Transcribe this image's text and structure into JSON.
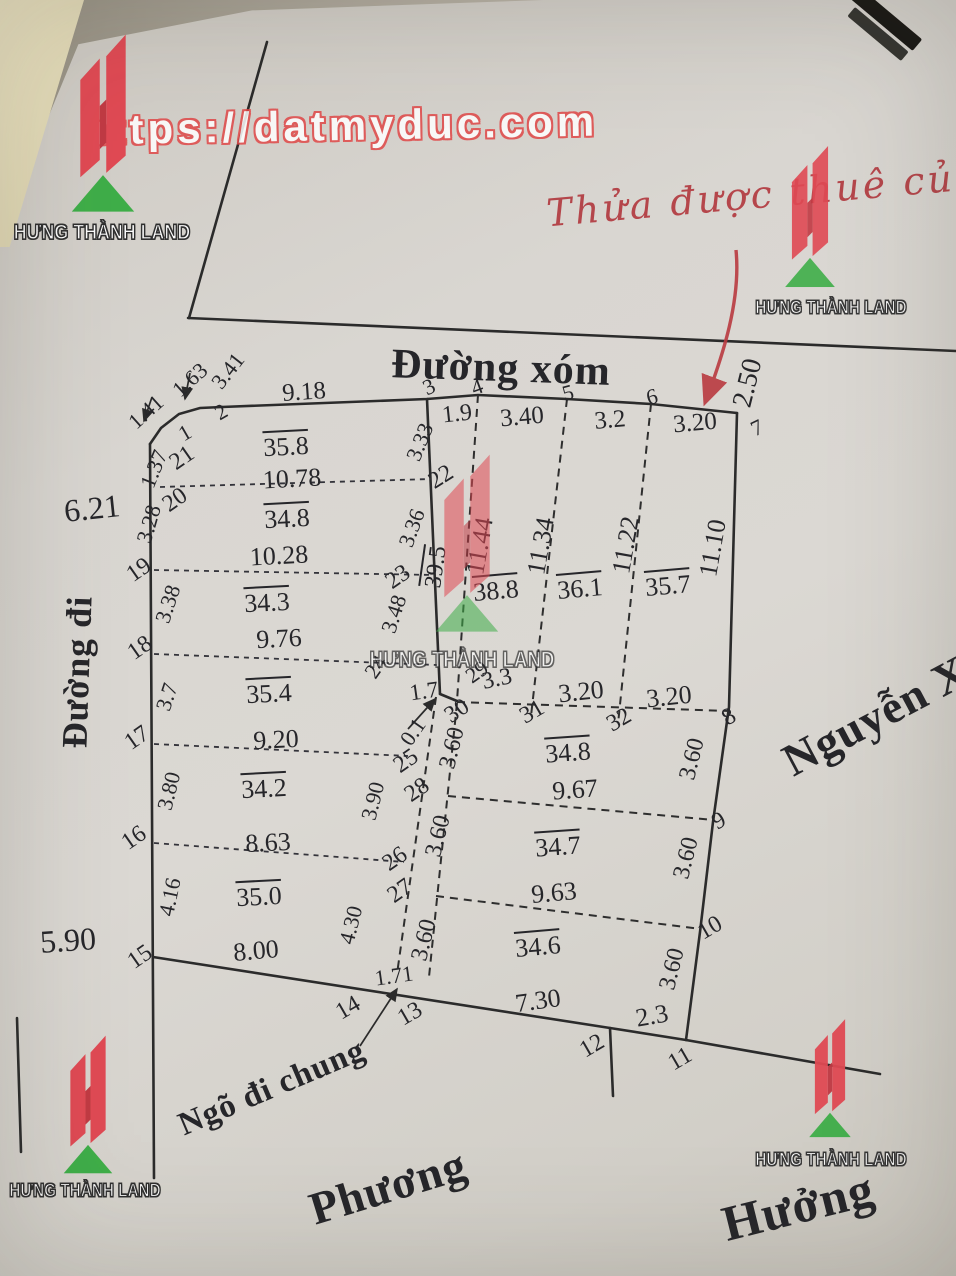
{
  "brand": "HƯNG THÀNH LAND",
  "watermark_url": "https://datmyduc.com",
  "handwriting": "Thửa được thuê của t",
  "colors": {
    "line": "#2b2b2b",
    "red_mark": "#b93a40",
    "logo_red": "#e04a54",
    "logo_green": "#3fae49",
    "paper": "#d9d6d1"
  },
  "roads": {
    "top": "Đường xóm",
    "left": "Đường đi",
    "alley": "Ngõ đi chung",
    "neighbor_bottom_left": "Phương",
    "neighbor_bottom_right": "Hưởng",
    "neighbor_right": "Nguyễn X"
  },
  "labels": [
    {
      "t": "https://datmyduc.com",
      "x": 340,
      "y": 126,
      "r": -1,
      "s": 42,
      "c": "url",
      "n": "watermark-url"
    },
    {
      "t": "Thửa được thuê của t",
      "x": 780,
      "y": 193,
      "r": -5,
      "s": 38,
      "c": "hand",
      "n": "handwritten-note"
    },
    {
      "t": "Đường xóm",
      "x": 501,
      "y": 368,
      "r": 2,
      "s": 42,
      "c": "road",
      "n": "top-road-label"
    },
    {
      "t": "Đường đi",
      "x": 77,
      "y": 672,
      "r": -88,
      "s": 36,
      "c": "road",
      "n": "left-road-label"
    },
    {
      "t": "Ngõ đi chung",
      "x": 272,
      "y": 1088,
      "r": -23,
      "s": 33,
      "c": "road2",
      "n": "alley-label"
    },
    {
      "t": "Phương",
      "x": 388,
      "y": 1187,
      "r": -17,
      "s": 46,
      "c": "road2",
      "n": "neighbor-phuong-label"
    },
    {
      "t": "Hưởng",
      "x": 798,
      "y": 1206,
      "r": -14,
      "s": 50,
      "c": "road2",
      "n": "neighbor-huong-label"
    },
    {
      "t": "Nguyễn X",
      "x": 876,
      "y": 716,
      "r": -28,
      "s": 46,
      "c": "road2",
      "n": "neighbor-nguyen-label"
    },
    {
      "t": "6.21",
      "x": 92,
      "y": 508,
      "r": -6,
      "s": 32,
      "c": "num",
      "n": "measure"
    },
    {
      "t": "5.90",
      "x": 68,
      "y": 940,
      "r": -4,
      "s": 32,
      "c": "num",
      "n": "measure"
    },
    {
      "t": "2.50",
      "x": 748,
      "y": 383,
      "r": -76,
      "s": 28,
      "c": "num",
      "n": "measure"
    },
    {
      "t": "1.63",
      "x": 190,
      "y": 380,
      "r": -42,
      "s": 22,
      "c": "num",
      "n": "measure"
    },
    {
      "t": "3.41",
      "x": 228,
      "y": 371,
      "r": -52,
      "s": 22,
      "c": "num",
      "n": "measure"
    },
    {
      "t": "9.18",
      "x": 304,
      "y": 392,
      "r": -4,
      "s": 25,
      "c": "num",
      "n": "measure"
    },
    {
      "t": "1.41",
      "x": 146,
      "y": 412,
      "r": -42,
      "s": 22,
      "c": "num",
      "n": "measure"
    },
    {
      "t": "2",
      "x": 221,
      "y": 412,
      "r": -30,
      "s": 22,
      "c": "pt",
      "n": "point-2"
    },
    {
      "t": "1",
      "x": 185,
      "y": 433,
      "r": -30,
      "s": 22,
      "c": "pt",
      "n": "point-1"
    },
    {
      "t": "1.37",
      "x": 154,
      "y": 469,
      "r": -68,
      "s": 22,
      "c": "num",
      "n": "measure"
    },
    {
      "t": "21",
      "x": 182,
      "y": 458,
      "r": -35,
      "s": 24,
      "c": "pt",
      "n": "point-21"
    },
    {
      "t": "20",
      "x": 175,
      "y": 500,
      "r": -35,
      "s": 24,
      "c": "pt",
      "n": "point-20"
    },
    {
      "t": "3.28",
      "x": 149,
      "y": 524,
      "r": -74,
      "s": 22,
      "c": "num",
      "n": "measure"
    },
    {
      "t": "19",
      "x": 139,
      "y": 570,
      "r": -35,
      "s": 24,
      "c": "pt",
      "n": "point-19"
    },
    {
      "t": "3.38",
      "x": 168,
      "y": 604,
      "r": -72,
      "s": 22,
      "c": "num",
      "n": "measure"
    },
    {
      "t": "18",
      "x": 140,
      "y": 648,
      "r": -35,
      "s": 24,
      "c": "pt",
      "n": "point-18"
    },
    {
      "t": "3.7",
      "x": 167,
      "y": 697,
      "r": -72,
      "s": 22,
      "c": "num",
      "n": "measure"
    },
    {
      "t": "17",
      "x": 137,
      "y": 738,
      "r": -35,
      "s": 24,
      "c": "pt",
      "n": "point-17"
    },
    {
      "t": "3.80",
      "x": 169,
      "y": 791,
      "r": -76,
      "s": 22,
      "c": "num",
      "n": "measure"
    },
    {
      "t": "16",
      "x": 134,
      "y": 838,
      "r": -35,
      "s": 24,
      "c": "pt",
      "n": "point-16"
    },
    {
      "t": "4.16",
      "x": 170,
      "y": 897,
      "r": -78,
      "s": 22,
      "c": "num",
      "n": "measure"
    },
    {
      "t": "15",
      "x": 140,
      "y": 957,
      "r": -35,
      "s": 24,
      "c": "pt",
      "n": "point-15"
    },
    {
      "t": "35.8",
      "x": 286,
      "y": 447,
      "r": -3,
      "s": 26,
      "c": "area",
      "n": "parcel-area"
    },
    {
      "t": "10.78",
      "x": 292,
      "y": 479,
      "r": -3,
      "s": 26,
      "c": "num",
      "n": "measure"
    },
    {
      "t": "34.8",
      "x": 287,
      "y": 519,
      "r": -3,
      "s": 26,
      "c": "area",
      "n": "parcel-area"
    },
    {
      "t": "10.28",
      "x": 279,
      "y": 556,
      "r": -3,
      "s": 26,
      "c": "num",
      "n": "measure"
    },
    {
      "t": "34.3",
      "x": 267,
      "y": 603,
      "r": -3,
      "s": 26,
      "c": "area",
      "n": "parcel-area"
    },
    {
      "t": "9.76",
      "x": 279,
      "y": 639,
      "r": -3,
      "s": 26,
      "c": "num",
      "n": "measure"
    },
    {
      "t": "35.4",
      "x": 269,
      "y": 694,
      "r": -3,
      "s": 26,
      "c": "area",
      "n": "parcel-area"
    },
    {
      "t": "9.20",
      "x": 276,
      "y": 740,
      "r": -3,
      "s": 26,
      "c": "num",
      "n": "measure"
    },
    {
      "t": "34.2",
      "x": 264,
      "y": 789,
      "r": -3,
      "s": 26,
      "c": "area",
      "n": "parcel-area"
    },
    {
      "t": "8.63",
      "x": 268,
      "y": 843,
      "r": -3,
      "s": 26,
      "c": "num",
      "n": "measure"
    },
    {
      "t": "35.0",
      "x": 259,
      "y": 897,
      "r": -3,
      "s": 26,
      "c": "area",
      "n": "parcel-area"
    },
    {
      "t": "8.00",
      "x": 256,
      "y": 951,
      "r": -5,
      "s": 26,
      "c": "num",
      "n": "measure"
    },
    {
      "t": "3",
      "x": 429,
      "y": 387,
      "r": -25,
      "s": 22,
      "c": "pt",
      "n": "point-3"
    },
    {
      "t": "3.33",
      "x": 420,
      "y": 442,
      "r": -68,
      "s": 22,
      "c": "num",
      "n": "measure"
    },
    {
      "t": "22",
      "x": 441,
      "y": 477,
      "r": -32,
      "s": 24,
      "c": "pt",
      "n": "point-22"
    },
    {
      "t": "3.36",
      "x": 412,
      "y": 528,
      "r": -70,
      "s": 22,
      "c": "num",
      "n": "measure"
    },
    {
      "t": "23",
      "x": 398,
      "y": 577,
      "r": -35,
      "s": 24,
      "c": "pt",
      "n": "point-23"
    },
    {
      "t": "3.48",
      "x": 394,
      "y": 614,
      "r": -72,
      "s": 22,
      "c": "num",
      "n": "measure"
    },
    {
      "t": "24",
      "x": 376,
      "y": 667,
      "r": -55,
      "s": 22,
      "c": "pt",
      "n": "point-24"
    },
    {
      "t": "1.9",
      "x": 457,
      "y": 414,
      "r": -6,
      "s": 24,
      "c": "num",
      "n": "measure"
    },
    {
      "t": "4",
      "x": 477,
      "y": 387,
      "r": -20,
      "s": 22,
      "c": "pt",
      "n": "point-4"
    },
    {
      "t": "3.40",
      "x": 522,
      "y": 417,
      "r": -5,
      "s": 25,
      "c": "num",
      "n": "measure"
    },
    {
      "t": "5",
      "x": 568,
      "y": 393,
      "r": -15,
      "s": 22,
      "c": "pt",
      "n": "point-5"
    },
    {
      "t": "3.2",
      "x": 610,
      "y": 420,
      "r": -5,
      "s": 25,
      "c": "num",
      "n": "measure"
    },
    {
      "t": "6",
      "x": 652,
      "y": 397,
      "r": -15,
      "s": 22,
      "c": "pt",
      "n": "point-6"
    },
    {
      "t": "3.20",
      "x": 695,
      "y": 423,
      "r": -5,
      "s": 25,
      "c": "num",
      "n": "measure"
    },
    {
      "t": "7",
      "x": 757,
      "y": 428,
      "r": -25,
      "s": 22,
      "c": "pt",
      "n": "point-7"
    },
    {
      "t": "39.5",
      "x": 436,
      "y": 567,
      "r": -82,
      "s": 24,
      "c": "area",
      "n": "parcel-area"
    },
    {
      "t": "11.44",
      "x": 480,
      "y": 546,
      "r": -80,
      "s": 26,
      "c": "num",
      "n": "measure"
    },
    {
      "t": "38.8",
      "x": 496,
      "y": 591,
      "r": -5,
      "s": 26,
      "c": "area",
      "n": "parcel-area"
    },
    {
      "t": "11.34",
      "x": 541,
      "y": 546,
      "r": -80,
      "s": 26,
      "c": "num",
      "n": "measure"
    },
    {
      "t": "36.1",
      "x": 580,
      "y": 589,
      "r": -5,
      "s": 26,
      "c": "area",
      "n": "parcel-area"
    },
    {
      "t": "11.22",
      "x": 626,
      "y": 545,
      "r": -80,
      "s": 26,
      "c": "num",
      "n": "measure"
    },
    {
      "t": "35.7",
      "x": 668,
      "y": 586,
      "r": -5,
      "s": 26,
      "c": "area",
      "n": "parcel-area"
    },
    {
      "t": "11.10",
      "x": 713,
      "y": 548,
      "r": -80,
      "s": 26,
      "c": "num",
      "n": "measure"
    },
    {
      "t": "1.7",
      "x": 424,
      "y": 691,
      "r": -8,
      "s": 23,
      "c": "num",
      "n": "measure"
    },
    {
      "t": "29",
      "x": 477,
      "y": 672,
      "r": -35,
      "s": 22,
      "c": "pt",
      "n": "point-29"
    },
    {
      "t": "3.3",
      "x": 497,
      "y": 679,
      "r": -12,
      "s": 24,
      "c": "num",
      "n": "measure"
    },
    {
      "t": "0.1",
      "x": 413,
      "y": 732,
      "r": -55,
      "s": 22,
      "c": "num",
      "n": "measure"
    },
    {
      "t": "30",
      "x": 457,
      "y": 711,
      "r": -35,
      "s": 24,
      "c": "pt",
      "n": "point-30"
    },
    {
      "t": "31",
      "x": 532,
      "y": 712,
      "r": -30,
      "s": 24,
      "c": "pt",
      "n": "point-31"
    },
    {
      "t": "3.20",
      "x": 581,
      "y": 692,
      "r": -6,
      "s": 26,
      "c": "num",
      "n": "measure"
    },
    {
      "t": "32",
      "x": 619,
      "y": 720,
      "r": -30,
      "s": 24,
      "c": "pt",
      "n": "point-32"
    },
    {
      "t": "3.20",
      "x": 669,
      "y": 697,
      "r": -6,
      "s": 26,
      "c": "num",
      "n": "measure"
    },
    {
      "t": "8",
      "x": 729,
      "y": 717,
      "r": -30,
      "s": 24,
      "c": "pt",
      "n": "point-8"
    },
    {
      "t": "25",
      "x": 406,
      "y": 761,
      "r": -35,
      "s": 24,
      "c": "pt",
      "n": "point-25"
    },
    {
      "t": "28",
      "x": 417,
      "y": 790,
      "r": -35,
      "s": 24,
      "c": "pt",
      "n": "point-28"
    },
    {
      "t": "3.60",
      "x": 452,
      "y": 748,
      "r": -76,
      "s": 24,
      "c": "num",
      "n": "measure"
    },
    {
      "t": "34.8",
      "x": 568,
      "y": 753,
      "r": -4,
      "s": 26,
      "c": "area",
      "n": "parcel-area"
    },
    {
      "t": "9.67",
      "x": 575,
      "y": 790,
      "r": -4,
      "s": 26,
      "c": "num",
      "n": "measure"
    },
    {
      "t": "3.60",
      "x": 692,
      "y": 759,
      "r": -76,
      "s": 24,
      "c": "num",
      "n": "measure"
    },
    {
      "t": "9",
      "x": 719,
      "y": 821,
      "r": -30,
      "s": 24,
      "c": "pt",
      "n": "point-9"
    },
    {
      "t": "3.90",
      "x": 373,
      "y": 801,
      "r": -76,
      "s": 22,
      "c": "num",
      "n": "measure"
    },
    {
      "t": "26",
      "x": 395,
      "y": 859,
      "r": -35,
      "s": 24,
      "c": "pt",
      "n": "point-26"
    },
    {
      "t": "3.60",
      "x": 438,
      "y": 836,
      "r": -76,
      "s": 24,
      "c": "num",
      "n": "measure"
    },
    {
      "t": "34.7",
      "x": 558,
      "y": 847,
      "r": -4,
      "s": 26,
      "c": "area",
      "n": "parcel-area"
    },
    {
      "t": "3.60",
      "x": 686,
      "y": 858,
      "r": -76,
      "s": 24,
      "c": "num",
      "n": "measure"
    },
    {
      "t": "27",
      "x": 400,
      "y": 891,
      "r": -35,
      "s": 24,
      "c": "pt",
      "n": "point-27"
    },
    {
      "t": "9.63",
      "x": 554,
      "y": 893,
      "r": -5,
      "s": 26,
      "c": "num",
      "n": "measure"
    },
    {
      "t": "4.30",
      "x": 351,
      "y": 925,
      "r": -76,
      "s": 22,
      "c": "num",
      "n": "measure"
    },
    {
      "t": "3.60",
      "x": 424,
      "y": 940,
      "r": -76,
      "s": 24,
      "c": "num",
      "n": "measure"
    },
    {
      "t": "10",
      "x": 710,
      "y": 928,
      "r": -30,
      "s": 24,
      "c": "pt",
      "n": "point-10"
    },
    {
      "t": "34.6",
      "x": 538,
      "y": 947,
      "r": -5,
      "s": 26,
      "c": "area",
      "n": "parcel-area"
    },
    {
      "t": "3.60",
      "x": 672,
      "y": 969,
      "r": -76,
      "s": 24,
      "c": "num",
      "n": "measure"
    },
    {
      "t": "1.71",
      "x": 394,
      "y": 976,
      "r": -8,
      "s": 22,
      "c": "num",
      "n": "measure"
    },
    {
      "t": "7.30",
      "x": 538,
      "y": 1001,
      "r": -8,
      "s": 26,
      "c": "num",
      "n": "measure"
    },
    {
      "t": "2.3",
      "x": 652,
      "y": 1016,
      "r": -10,
      "s": 26,
      "c": "num",
      "n": "measure"
    },
    {
      "t": "14",
      "x": 348,
      "y": 1008,
      "r": -30,
      "s": 24,
      "c": "pt",
      "n": "point-14"
    },
    {
      "t": "13",
      "x": 410,
      "y": 1014,
      "r": -30,
      "s": 24,
      "c": "pt",
      "n": "point-13"
    },
    {
      "t": "12",
      "x": 592,
      "y": 1046,
      "r": -30,
      "s": 24,
      "c": "pt",
      "n": "point-12"
    },
    {
      "t": "11",
      "x": 680,
      "y": 1059,
      "r": -30,
      "s": 24,
      "c": "pt",
      "n": "point-11"
    }
  ],
  "logos": [
    {
      "x": 103,
      "y": 120,
      "k": 1.08,
      "o": 1.0,
      "tx": 102,
      "ty": 233,
      "ts": 21,
      "to": 1.0
    },
    {
      "x": 810,
      "y": 214,
      "k": 0.86,
      "o": 0.9,
      "tx": 831,
      "ty": 308,
      "ts": 18,
      "to": 0.95
    },
    {
      "x": 467,
      "y": 540,
      "k": 1.08,
      "o": 0.55,
      "tx": 462,
      "ty": 660,
      "ts": 22,
      "to": 0.7
    },
    {
      "x": 88,
      "y": 1102,
      "k": 0.84,
      "o": 1.0,
      "tx": 85,
      "ty": 1191,
      "ts": 18,
      "to": 1.0
    },
    {
      "x": 830,
      "y": 1076,
      "k": 0.72,
      "o": 0.95,
      "tx": 831,
      "ty": 1160,
      "ts": 18,
      "to": 0.95
    }
  ]
}
